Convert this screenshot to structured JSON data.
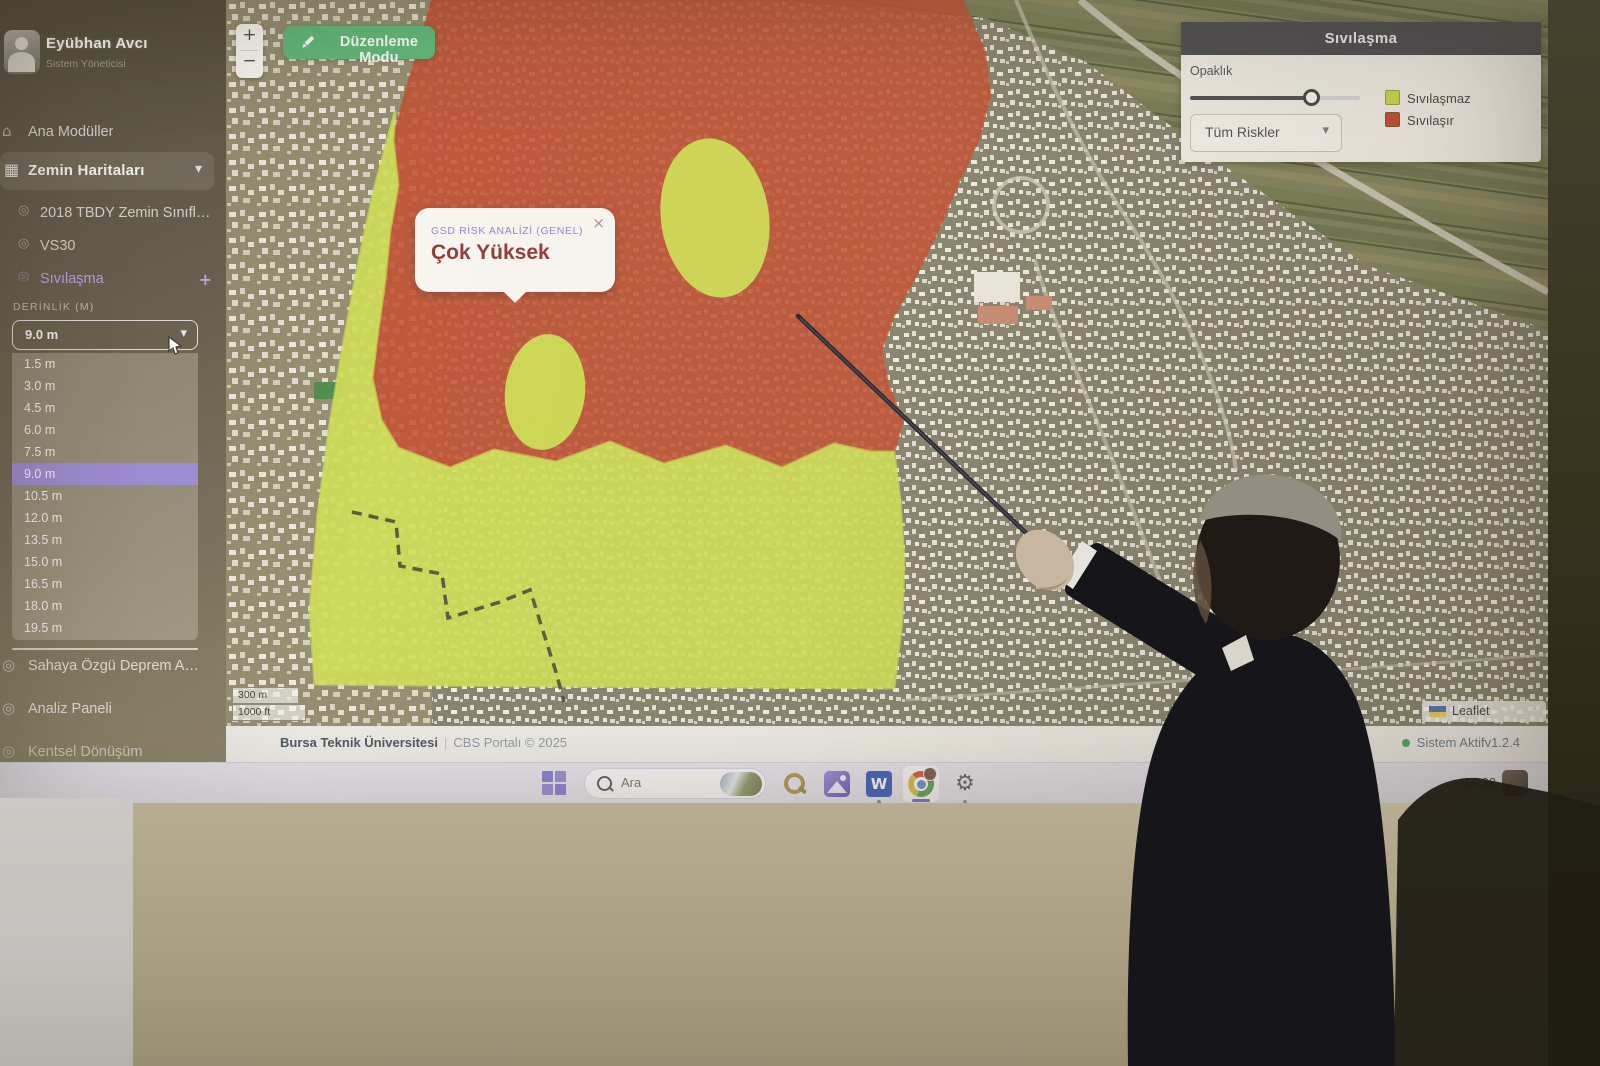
{
  "sidebar": {
    "user": {
      "name": "Eyübhan Avcı",
      "role": "Sistem Yöneticisi"
    },
    "menu": {
      "ana_moduller": "Ana Modüller",
      "zemin_haritalari": "Zemin Haritaları",
      "submenu": [
        "2018 TBDY Zemin Sınıflandı...",
        "VS30",
        "Sıvılaşma"
      ]
    },
    "depth": {
      "label": "DERİNLİK (M)",
      "selected": "9.0 m",
      "options": [
        "1.5 m",
        "3.0 m",
        "4.5 m",
        "6.0 m",
        "7.5 m",
        "9.0 m",
        "10.5 m",
        "12.0 m",
        "13.5 m",
        "15.0 m",
        "16.5 m",
        "18.0 m",
        "19.5 m"
      ]
    },
    "tools": [
      "Sahaya Özgü Deprem Analizi",
      "Analiz Paneli",
      "Kentsel Dönüşüm"
    ]
  },
  "map": {
    "edit_button": "Düzenleme Modu",
    "zoom_in": "+",
    "zoom_out": "−",
    "popup": {
      "title": "GSD RİSK ANALİZİ (GENEL)",
      "value": "Çok Yüksek",
      "close": "×"
    },
    "panel": {
      "title": "Sıvılaşma",
      "opacity_label": "Opaklık",
      "opacity_percent": 72,
      "risk_select": "Tüm Riskler",
      "legend": [
        {
          "label": "Sıvılaşmaz",
          "color": "#c9dc4a"
        },
        {
          "label": "Sıvılaşır",
          "color": "#bf4a2e"
        }
      ]
    },
    "scalebar": {
      "metric": "300 m",
      "imperial": "1000 ft"
    },
    "attribution": "Leaflet"
  },
  "footer": {
    "org": "Bursa Teknik Üniversitesi",
    "separator": "|",
    "portal": "CBS Portalı © 2025",
    "status": "Sistem Aktif",
    "version": "v1.2.4"
  },
  "taskbar": {
    "search_placeholder": "Ara",
    "time": "14:38"
  },
  "icons": {
    "home": "⌂",
    "grid": "▦",
    "chevron_down": "▾",
    "plus": "+",
    "bullet": "◎",
    "gear": "⚙",
    "word_letter": "W"
  },
  "colors": {
    "accent_purple": "#9f8edb",
    "edit_green": "#5cb878",
    "risk_red": "#bf4a2e",
    "risk_yellow": "#c9dc4a",
    "panel_header": "#47474f",
    "status_green": "#3fae62"
  }
}
